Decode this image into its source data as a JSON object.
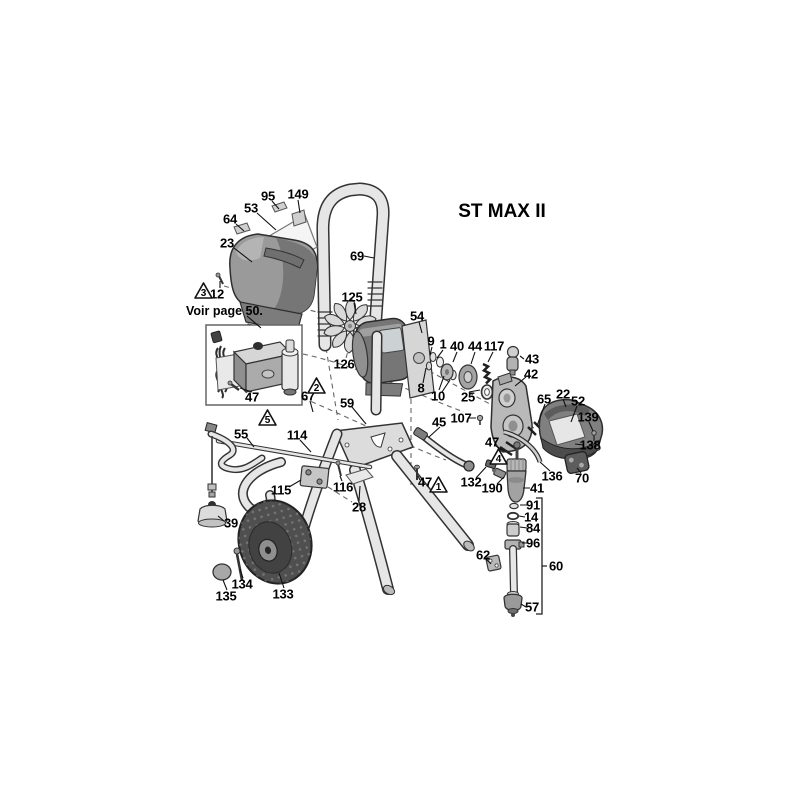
{
  "title": "ST MAX II",
  "note": "Voir page 50.",
  "colors": {
    "background": "#ffffff",
    "line": "#333333",
    "tube_fill": "#e6e6e6",
    "cover_gray": "#9a9a9a",
    "motor_gray": "#767676",
    "shield_gray": "#808080",
    "wheel_dark": "#4f4f4f",
    "panel_light": "#f5f5f5"
  },
  "parts": {
    "p95": "95",
    "p149": "149",
    "p53": "53",
    "p64": "64",
    "p23": "23",
    "p12": "12",
    "p69": "69",
    "p125": "125",
    "p54": "54",
    "p126": "126",
    "p9": "9",
    "p1": "1",
    "p40": "40",
    "p44": "44",
    "p117": "117",
    "p43": "43",
    "p42": "42",
    "p8": "8",
    "p10": "10",
    "p25": "25",
    "p65": "65",
    "p22": "22",
    "p52": "52",
    "p139": "139",
    "p138": "138",
    "p136": "136",
    "p70": "70",
    "p47a": "47",
    "p47b": "47",
    "p47c": "47",
    "p107": "107",
    "p45": "45",
    "p59": "59",
    "p67": "67",
    "p55": "55",
    "p114": "114",
    "p115": "115",
    "p116": "116",
    "p28": "28",
    "p39": "39",
    "p134": "134",
    "p135": "135",
    "p133": "133",
    "p132": "132",
    "p190": "190",
    "p41": "41",
    "p91": "91",
    "p14": "14",
    "p84": "84",
    "p96": "96",
    "p62": "62",
    "p60": "60",
    "p57": "57"
  },
  "warnings": {
    "w1": "1",
    "w2": "2",
    "w3": "3",
    "w4": "4",
    "w5": "5"
  }
}
